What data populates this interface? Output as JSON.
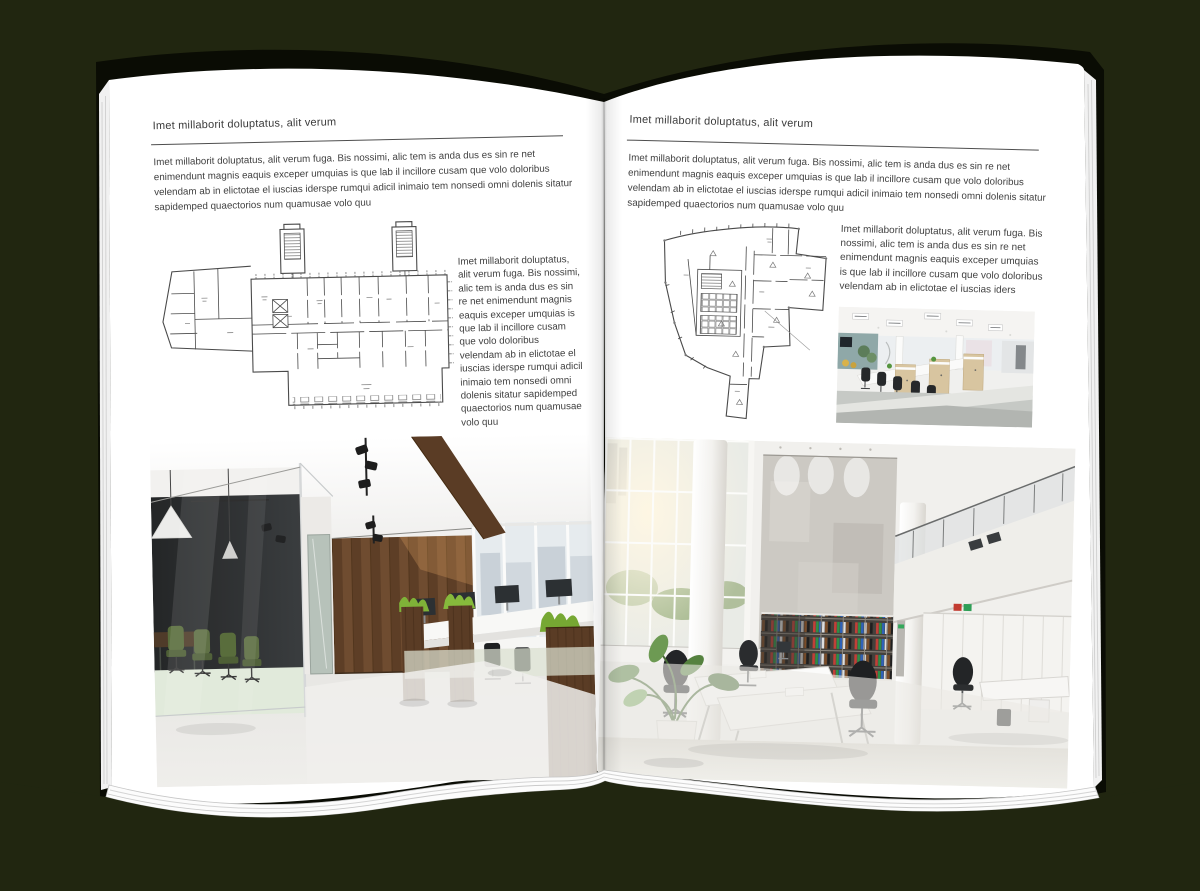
{
  "book": {
    "palette": {
      "background": "#212610",
      "cover": "#0a0c04",
      "paper": "#ffffff",
      "text": "#3e3e3e",
      "plan_line": "#4a4a4a"
    },
    "left_page": {
      "header": "Imet millaborit doluptatus, alit verum",
      "intro": "Imet millaborit doluptatus, alit verum fuga. Bis nossimi, alic tem is anda dus es sin re net enimendunt magnis eaquis exceper umquias is que lab il incillore cusam que volo doloribus velendam ab in elictotae el iuscias iderspe rumqui adicil inimaio tem nonsedi omni dolenis sitatur sapidemped quaectorios num quamusae volo quu",
      "side_text": "Imet millaborit doluptatus, alit verum fuga. Bis nossimi, alic tem is anda dus es sin re net enimendunt magnis eaquis exceper umquias is que lab il incillore cusam que volo doloribus velendam ab in elictotae el iuscias iderspe rumqui adicil inimaio tem nonsedi omni dolenis sitatur sapidemped quaectorios num quamusae volo quu",
      "floorplan_name": "elongated office building floor plan with two stair towers",
      "photo_name": "dark loft office with glass meeting room, wood wall and desks"
    },
    "right_page": {
      "header": "Imet millaborit doluptatus, alit verum",
      "intro": "Imet millaborit doluptatus, alit verum fuga. Bis nossimi, alic tem is anda dus es sin re net enimendunt magnis eaquis exceper umquias is que lab il incillore cusam que volo doloribus velendam ab in elictotae el iuscias iderspe rumqui adicil inimaio tem nonsedi omni dolenis sitatur sapidemped quaectorios num quamusae volo quu",
      "side_text": "Imet millaborit doluptatus, alit verum fuga. Bis nossimi, alic tem is anda dus es sin re net enimendunt magnis eaquis exceper umquias is que lab il incillore cusam que volo doloribus velendam ab in elictotae el iuscias iders",
      "floorplan_name": "wedge shaped office building floor plan",
      "photo_small_name": "open plan cubicle office with wooden workstations",
      "photo_large_name": "bright double height office with concrete wall and binder shelves"
    }
  }
}
